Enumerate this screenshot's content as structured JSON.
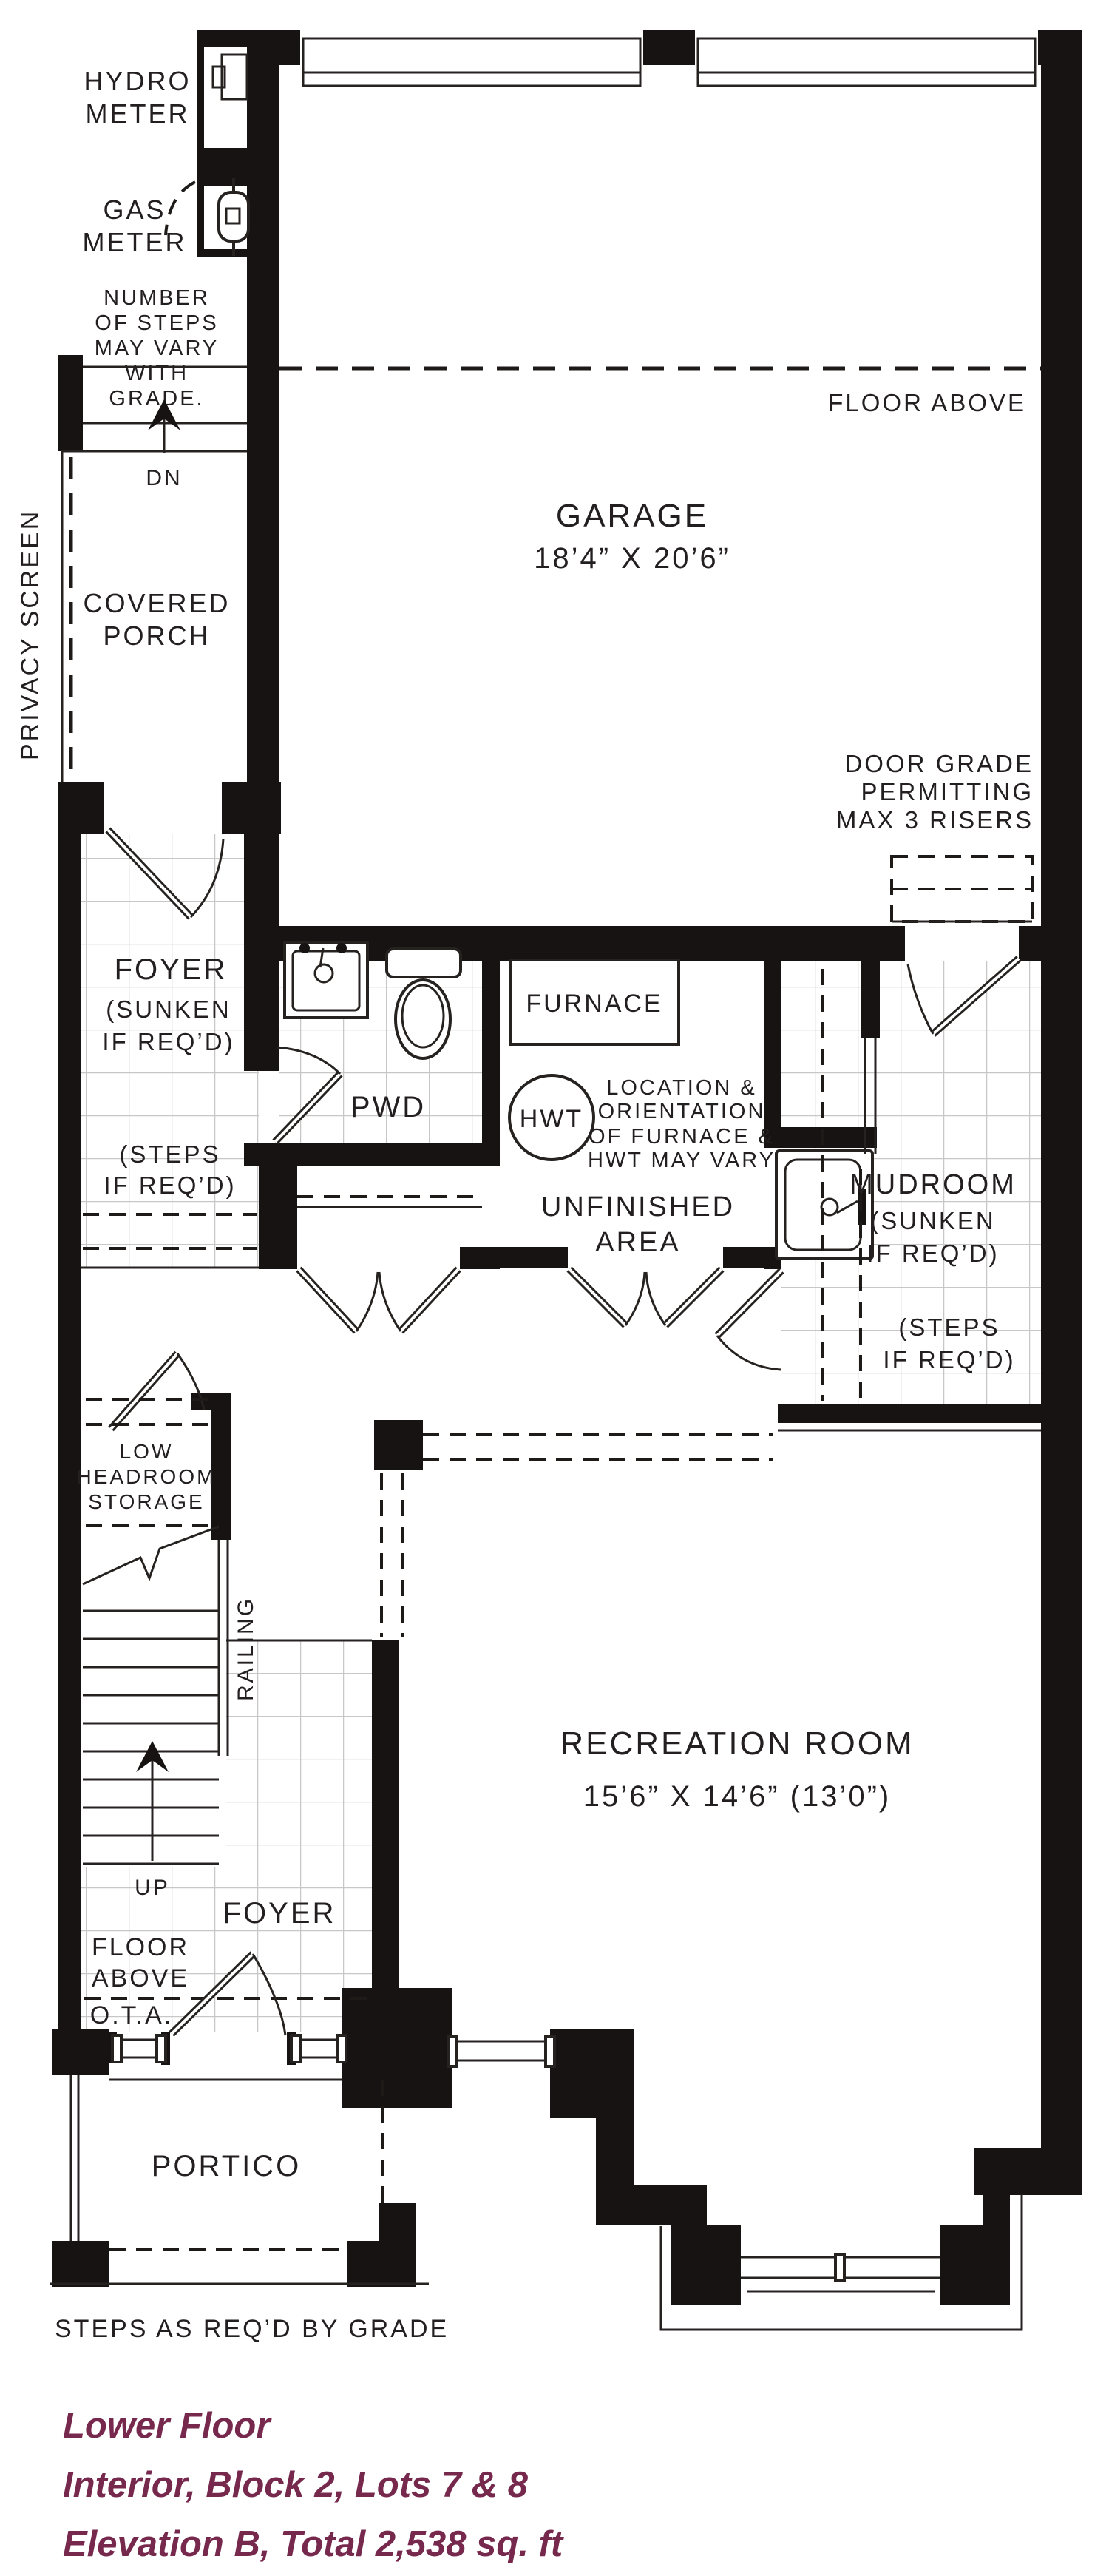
{
  "colors": {
    "wall": "#161312",
    "line": "#262220",
    "tile_grid": "#c7c7c7",
    "caption_text": "#76294d",
    "label_text": "#231f20",
    "background": "#ffffff"
  },
  "plan": {
    "meters": {
      "hydro": [
        "HYDRO",
        "METER"
      ],
      "gas": [
        "GAS",
        "METER"
      ]
    },
    "notes": {
      "steps_vary": [
        "NUMBER",
        "OF STEPS",
        "MAY VARY",
        "WITH",
        "GRADE."
      ],
      "dn": "DN",
      "up": "UP",
      "privacy_screen": "PRIVACY SCREEN",
      "floor_above_garage": "FLOOR ABOVE",
      "door_grade": [
        "DOOR GRADE",
        "PERMITTING",
        "MAX 3 RISERS"
      ],
      "steps_if_reqd_left": [
        "(STEPS",
        "IF REQ’D)"
      ],
      "steps_if_reqd_right": [
        "(STEPS",
        "IF REQ’D)"
      ],
      "location_note": [
        "LOCATION &",
        "ORIENTATION",
        "OF FURNACE &",
        "HWT MAY VARY"
      ],
      "low_headroom": [
        "LOW",
        "HEADROOM",
        "STORAGE"
      ],
      "railing": "RAILING",
      "floor_above_foyer": [
        "FLOOR",
        "ABOVE"
      ],
      "ota": "O.T.A.",
      "steps_by_grade": "STEPS AS REQ’D BY GRADE"
    },
    "rooms": {
      "garage": {
        "name": "GARAGE",
        "dims": "18’4” X 20’6”"
      },
      "covered_porch": [
        "COVERED",
        "PORCH"
      ],
      "foyer_upper": {
        "name": "FOYER",
        "sub": [
          "(SUNKEN",
          "IF REQ’D)"
        ]
      },
      "pwd": "PWD",
      "furnace": "FURNACE",
      "hwt": "HWT",
      "unfinished": [
        "UNFINISHED",
        "AREA"
      ],
      "mudroom": {
        "name": "MUDROOM",
        "sub": [
          "(SUNKEN",
          "IF REQ’D)"
        ]
      },
      "recreation": {
        "name": "RECREATION ROOM",
        "dims": "15’6” X 14’6” (13’0”)"
      },
      "foyer_lower": "FOYER",
      "portico": "PORTICO"
    },
    "caption": {
      "line1": "Lower Floor",
      "line2": "Interior, Block 2, Lots 7 & 8",
      "line3": "Elevation B, Total 2,538 sq. ft"
    }
  }
}
